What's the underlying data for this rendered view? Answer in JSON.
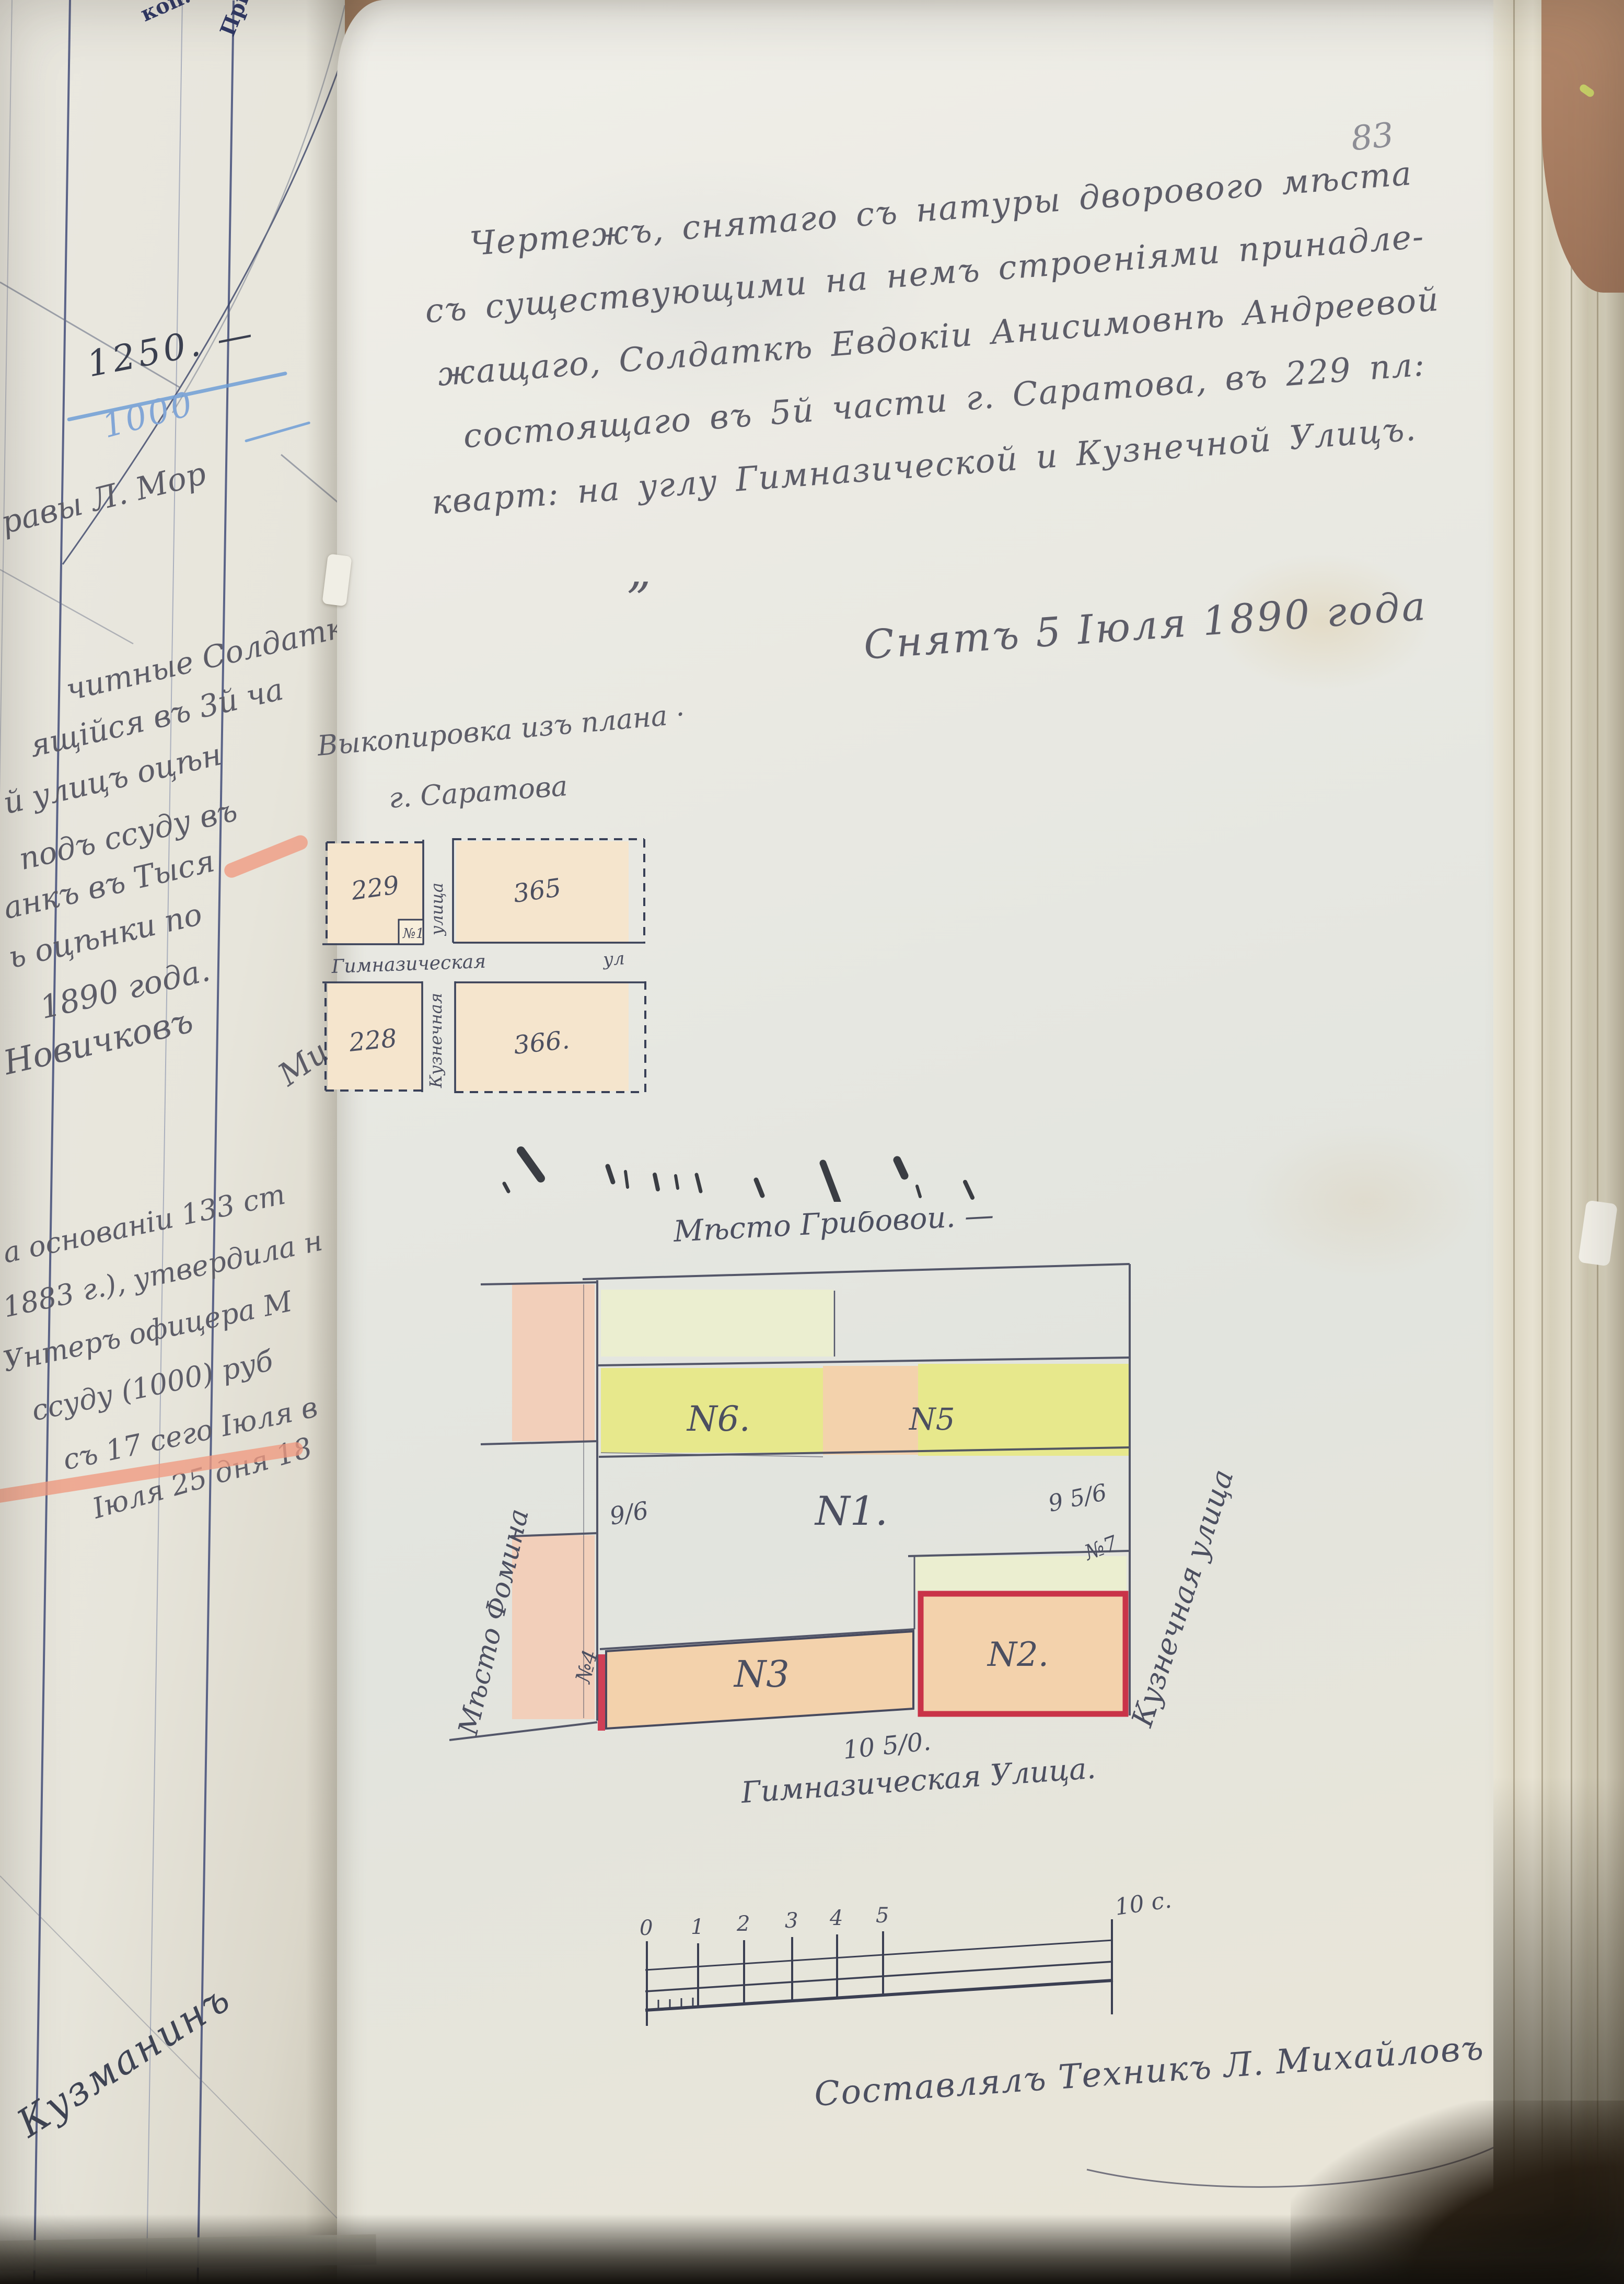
{
  "page": {
    "number": "83",
    "title_lines": [
      "Чертежъ, снятаго съ натуры дворового мѣста",
      "съ существующими на немъ строеніями принадле-",
      "жащаго, Солдаткѣ Евдокіи Анисимовнѣ Андреевой",
      "состоящаго въ 5й части г. Саратова, въ 229 пл:",
      "кварт: на углу Гимназической и Кузнечной Улицъ."
    ],
    "quote_mark": "„",
    "date_line": "Снятъ 5 Іюля 1890 года",
    "surveyor_line": "Составлялъ Техникъ Л. Михайловъ"
  },
  "inset": {
    "caption_line1": "Выкопировка изъ плана ·",
    "caption_line2": "г. Саратова",
    "block_nw": "229",
    "block_ne": "365",
    "block_sw": "228",
    "block_se": "366.",
    "plot_marker": "№1",
    "street_h_name": "Гимназическая",
    "street_h_suffix": "ул",
    "street_v_top": "улица",
    "street_v_bottom": "Кузнечная"
  },
  "plan": {
    "top_label": "Мѣсто Грибовой. —",
    "left_label": "Мѣсто Фомина",
    "right_label": "Кузнечная улица",
    "bottom_label": "Гимназическая Улица.",
    "parcel_n6": "N6.",
    "parcel_n5": "N5",
    "parcel_n1": "N1.",
    "parcel_n3": "N3",
    "parcel_n2": "N2.",
    "meas_left": "9/6",
    "meas_right": "9 5/6",
    "marker_right": "№7",
    "marker_left": "№4",
    "meas_bottom": "10 5/0."
  },
  "scale_bar": {
    "ticks": [
      "0",
      "1",
      "2",
      "3",
      "4",
      "5"
    ],
    "end_label": "10 с."
  },
  "left_page": {
    "col_header1": "коп.",
    "col_header2": "Прим.",
    "sum_crossed": "1250. —",
    "sum_blue": "1000",
    "frag_top": "равы Л. Мор",
    "frag_mi": "Ми",
    "fragments1": [
      "читные Солдатк",
      "ящійся въ 3й ча",
      "й улицъ оцѣн",
      "подъ ссуду въ",
      "анкъ въ Тыся",
      "ь оцѣнки по",
      "1890 года.",
      "Новичковъ"
    ],
    "fragments2": [
      "а основаніи 133 ст",
      "1883 г.), утвердила н",
      "Унтеръ офицера М",
      "ссуду (1000) руб",
      "съ 17 сего Іюля в",
      "Іюля 25 дня 18"
    ],
    "signature_diag": "Кузманинъ"
  },
  "colors": {
    "parcel_yellow": "#e7e88c",
    "parcel_peach": "#f3d2ac",
    "parcel_green": "#ebeed0",
    "parcel_pink": "#f2cfba",
    "block_cream": "#f5e5cd",
    "red_border": "#c93348",
    "red_stripe": "#d04056",
    "ink": "#474a5e"
  }
}
